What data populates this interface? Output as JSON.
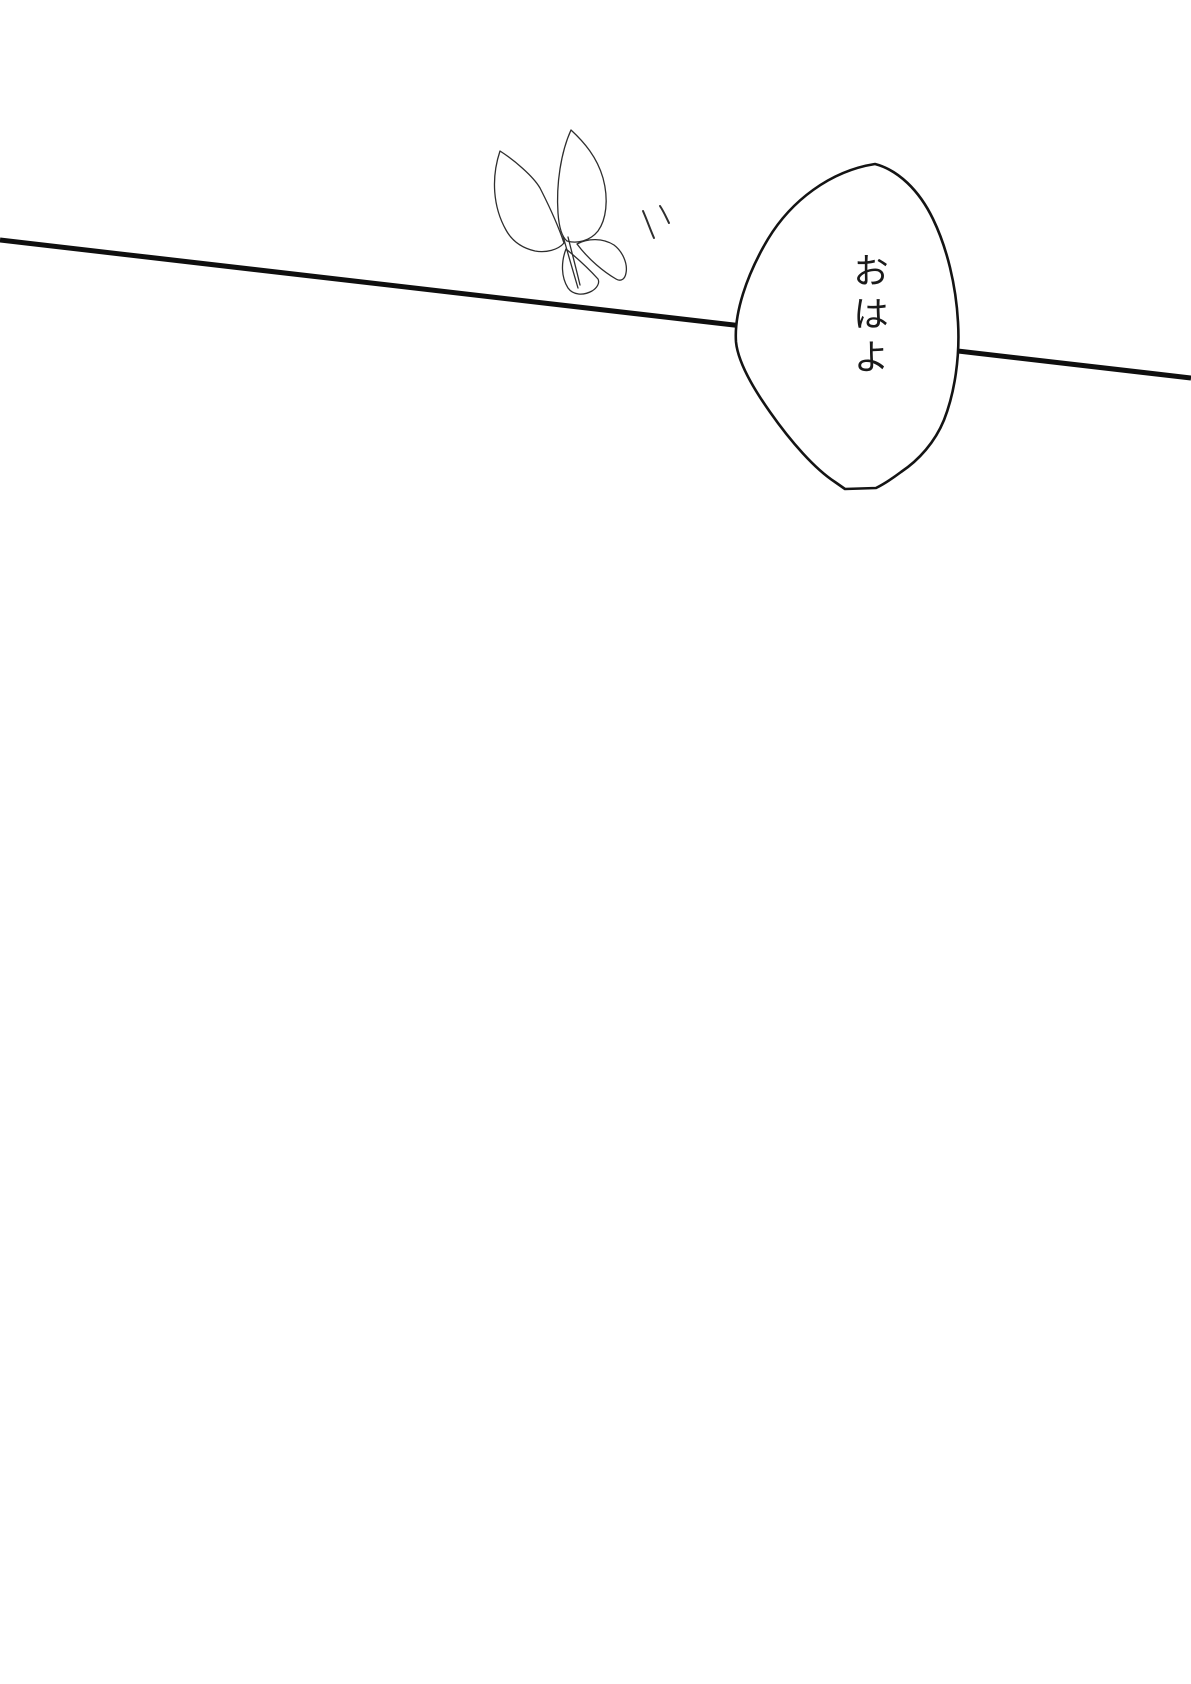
{
  "canvas": {
    "background_color": "#ffffff",
    "line_color": "#0f0f0f",
    "sketch_color": "#2e2e2e",
    "bubble_outline_color": "#141414",
    "bubble_fill_color": "#ffffff",
    "text_color": "#1a1a1a"
  },
  "bubble": {
    "text": "おはよ"
  }
}
